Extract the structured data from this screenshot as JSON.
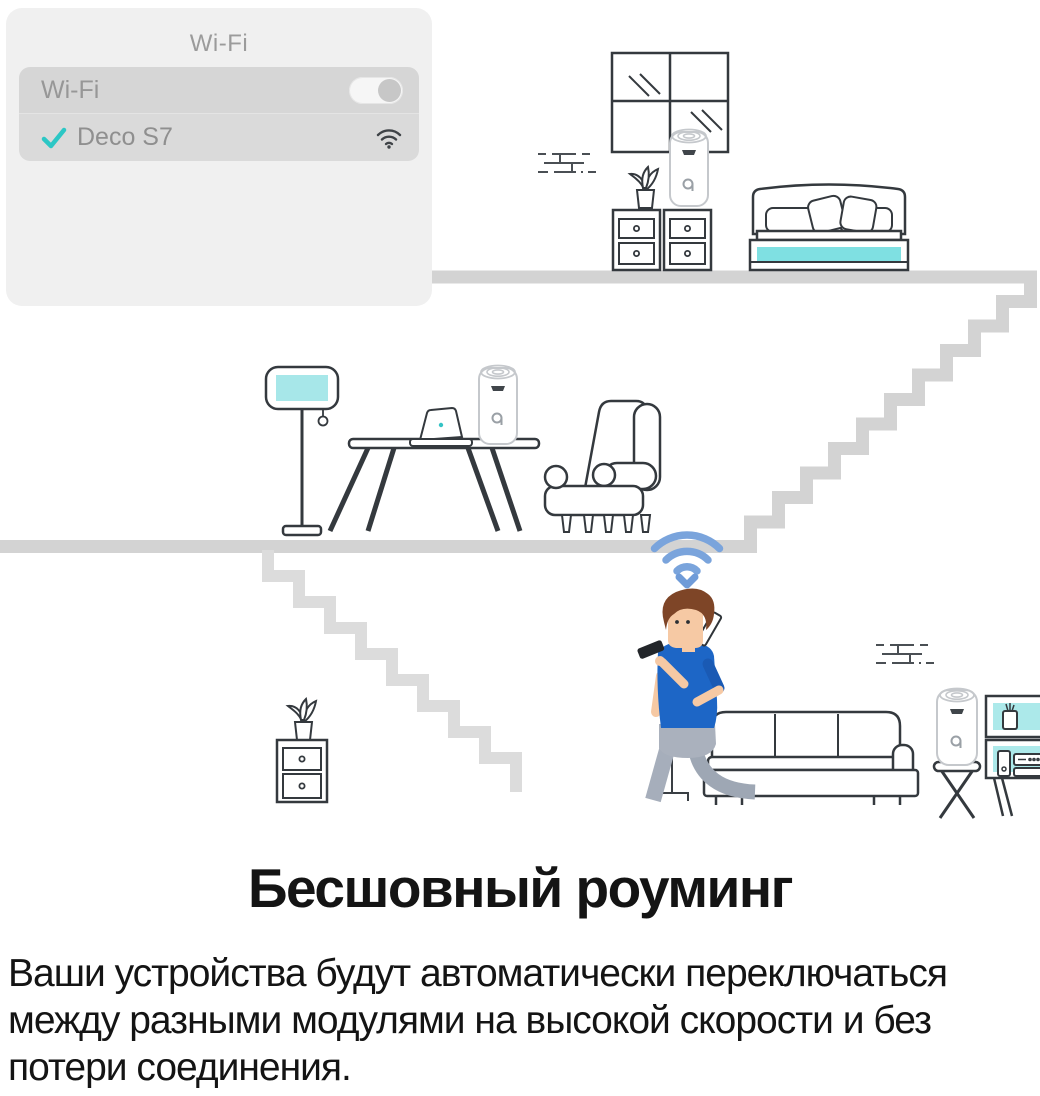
{
  "wifi_card": {
    "title": "Wi-Fi",
    "rows": {
      "toggle": {
        "label": "Wi-Fi",
        "state": "on"
      },
      "network": {
        "name": "Deco S7",
        "selected": true
      }
    }
  },
  "caption": {
    "heading": "Бесшовный роуминг",
    "body_lines": [
      "Ваши устройства будут автоматически переключаться",
      "между разными модулями на высокой скорости и без",
      "потери соединения."
    ]
  },
  "colors": {
    "teal_accent": "#7fe0e2",
    "teal_light": "#a7e7e9",
    "check_teal": "#2cc7c5",
    "wifi_blue": "#7aa4dc",
    "floor_gray": "#d3d3d3",
    "outline_ink": "#34393e"
  },
  "icons": {
    "selected_check": "checkmark",
    "network_signal": "wifi-arcs",
    "toggle": "switch-on",
    "roaming_signal": "wifi-arcs-down-chevron",
    "wall_section": "brick-dashes"
  }
}
